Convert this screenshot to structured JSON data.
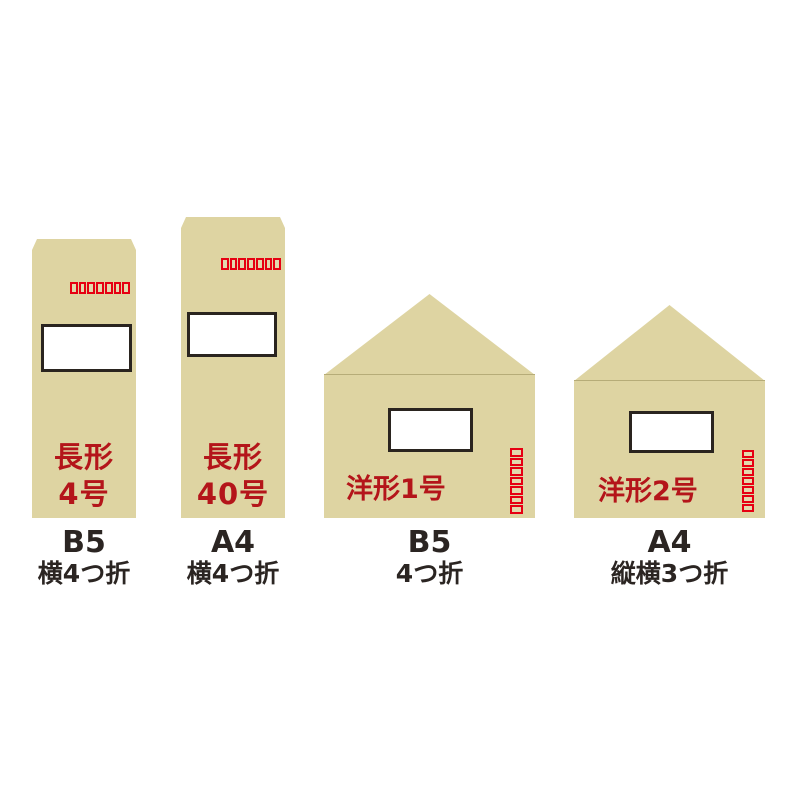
{
  "page": {
    "background": "#ffffff"
  },
  "colors": {
    "envelope_tan": "#ded4a2",
    "name_red": "#b4151a",
    "postal_box_red": "#e60012",
    "window_border": "#2a241f",
    "caption_text": "#2b2522"
  },
  "envelopes": [
    {
      "id": "nagagata-4",
      "name_line1": "長形",
      "name_line2": "4号",
      "caption_line1": "B5",
      "caption_line2": "横4つ折",
      "postal_boxes": 7,
      "postal_boxes_orientation": "horizontal",
      "flap": "trapezoid-top",
      "has_window": true
    },
    {
      "id": "nagagata-40",
      "name_line1": "長形",
      "name_line2": "40号",
      "caption_line1": "A4",
      "caption_line2": "横4つ折",
      "postal_boxes": 7,
      "postal_boxes_orientation": "horizontal",
      "flap": "trapezoid-top",
      "has_window": true
    },
    {
      "id": "yougata-1",
      "name": "洋形1号",
      "caption_line1": "B5",
      "caption_line2": "4つ折",
      "postal_boxes": 7,
      "postal_boxes_orientation": "vertical",
      "flap": "triangle-top",
      "has_window": true
    },
    {
      "id": "yougata-2",
      "name": "洋形2号",
      "caption_line1": "A4",
      "caption_line2": "縦横3つ折",
      "postal_boxes": 7,
      "postal_boxes_orientation": "vertical",
      "flap": "triangle-top",
      "has_window": true
    }
  ]
}
